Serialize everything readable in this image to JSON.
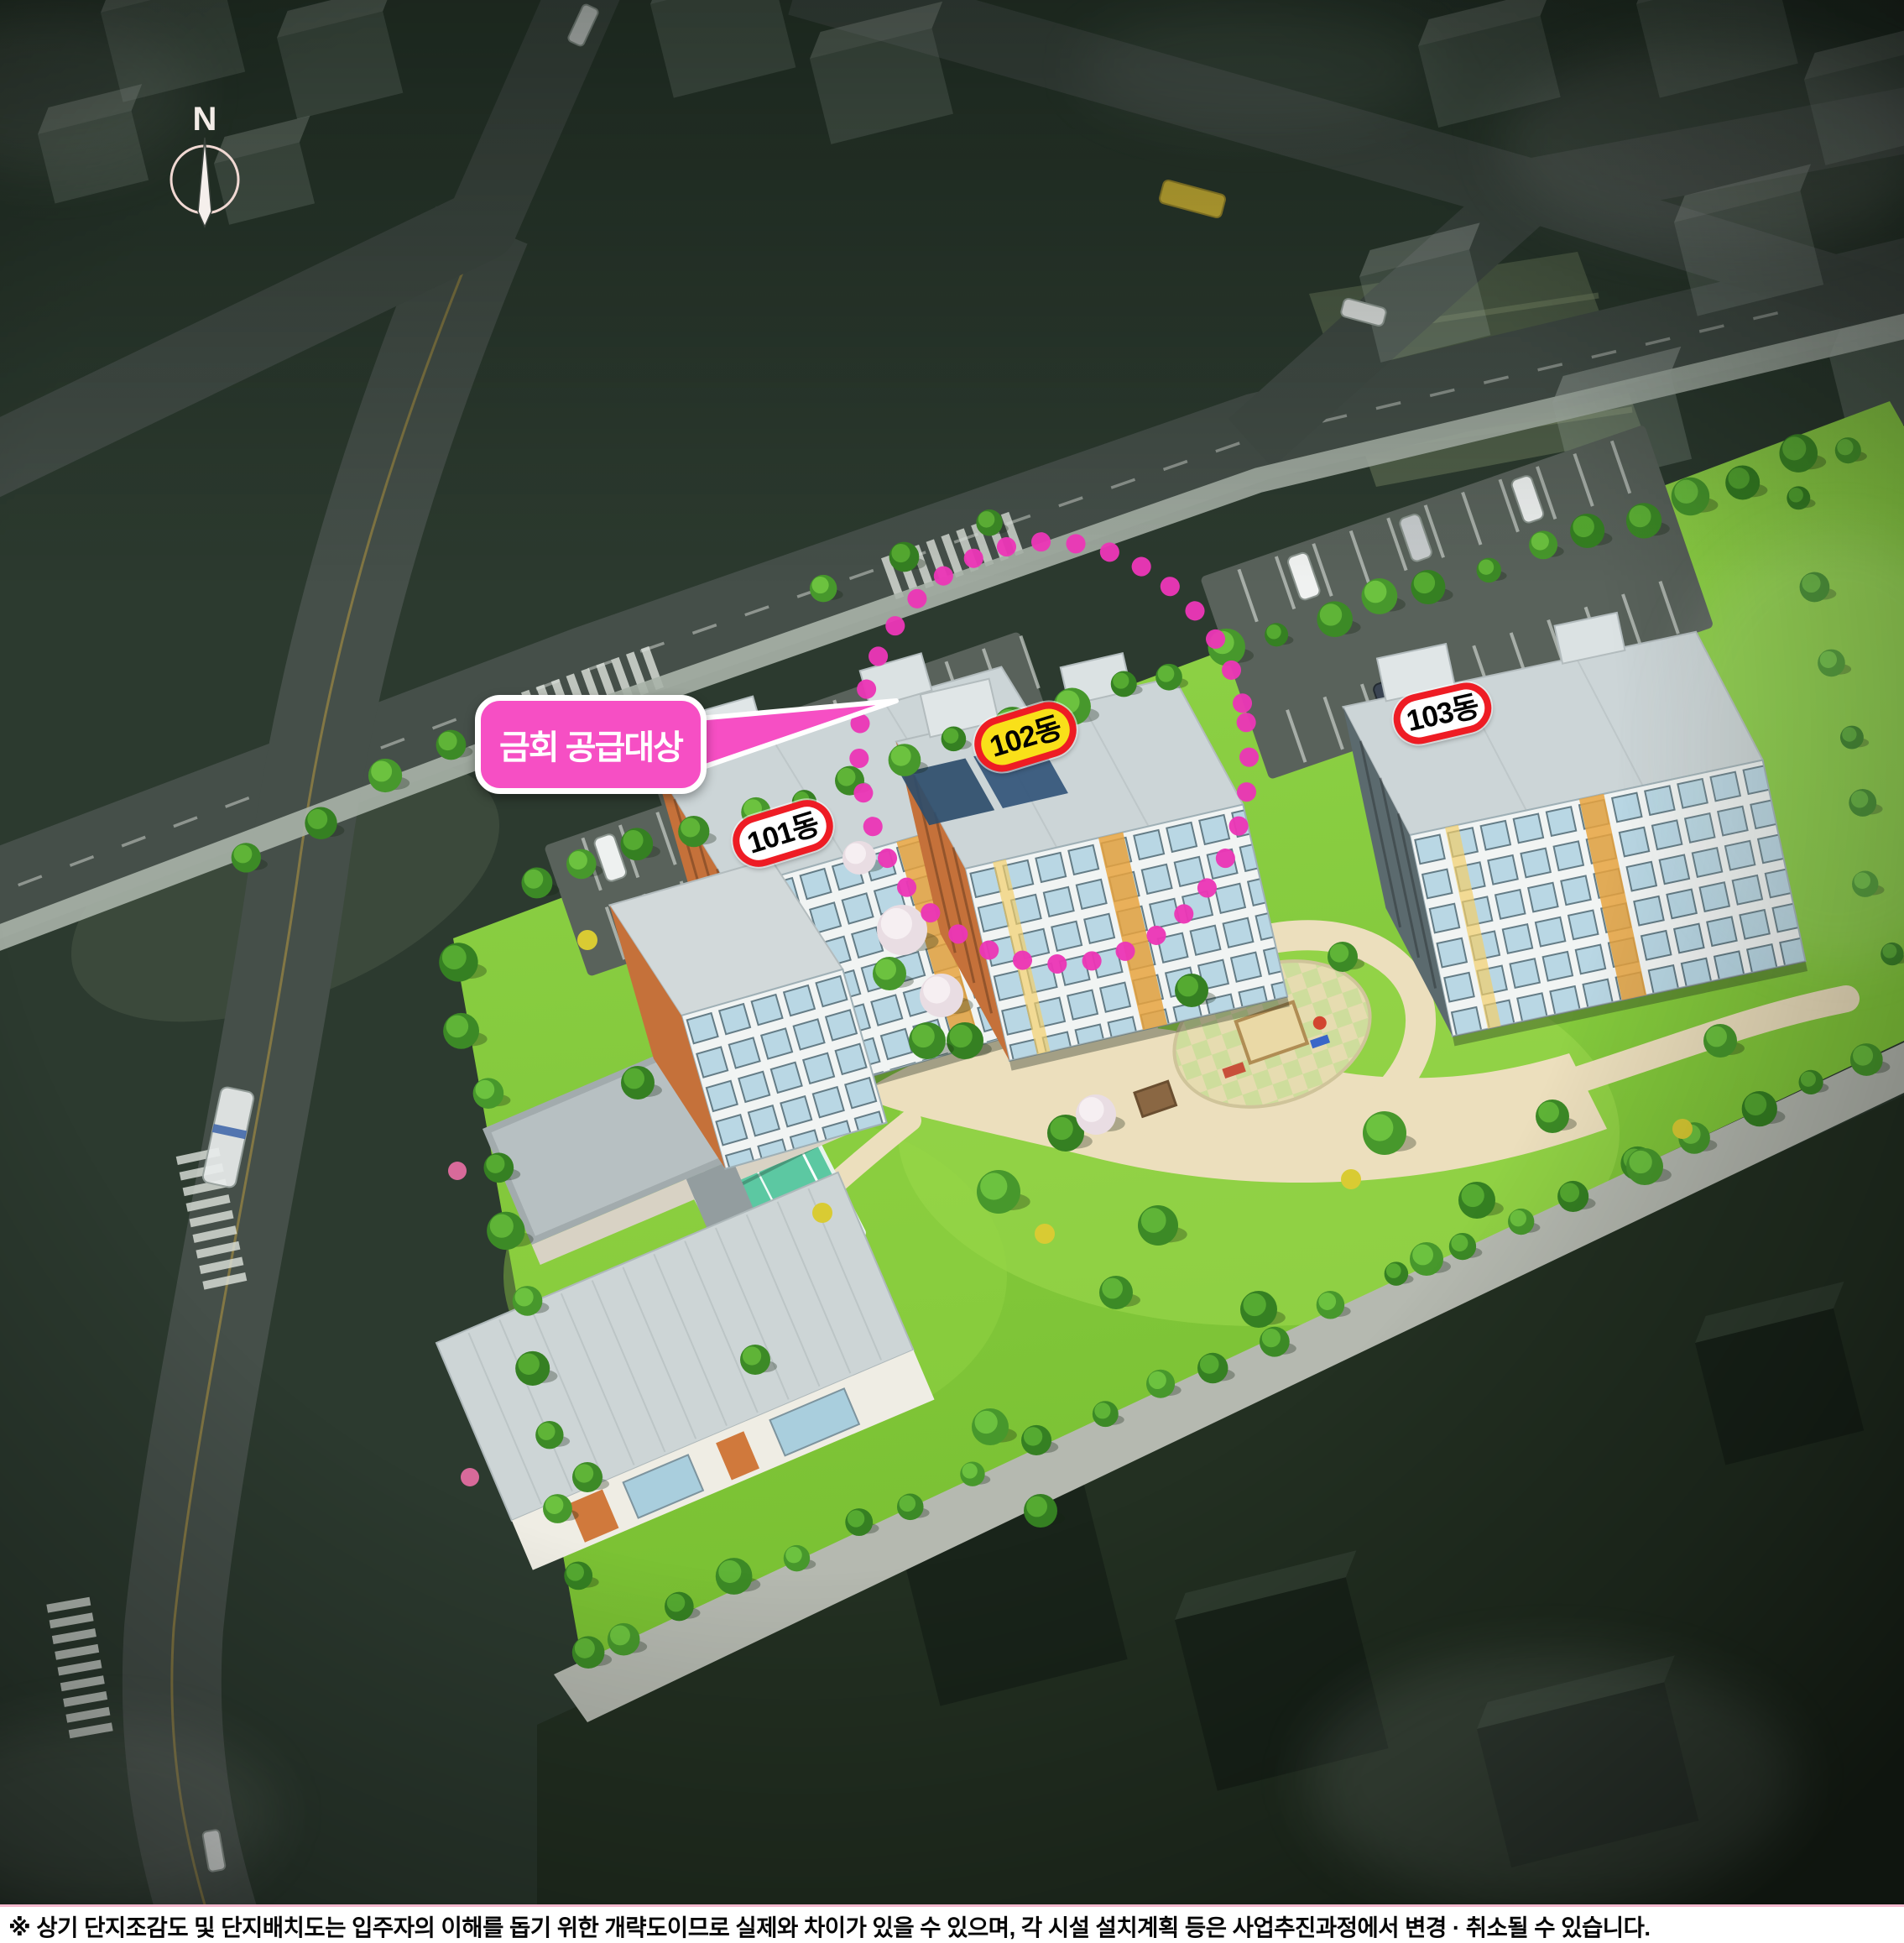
{
  "compass": {
    "label": "N"
  },
  "callout": {
    "label": "금회 공급대상",
    "fill": "#f64fc4",
    "border": "#ffffff",
    "points_to": "102동"
  },
  "buildings": [
    {
      "label": "101동",
      "badge_fill": "#ffffff",
      "badge_border": "#ee1c24",
      "highlighted": false
    },
    {
      "label": "102동",
      "badge_fill": "#f9e019",
      "badge_border": "#ee1c24",
      "highlighted": true
    },
    {
      "label": "103동",
      "badge_fill": "#ffffff",
      "badge_border": "#ee1c24",
      "highlighted": false
    }
  ],
  "highlight_circle": {
    "style": "dotted",
    "color": "#eb36b6",
    "encircles": "102동"
  },
  "site_features": {
    "amenities": [
      "tennis-court",
      "playground",
      "community-buildings",
      "parking-lots",
      "park"
    ],
    "grass_color": "#84ca3a",
    "path_color": "#ecdfbd",
    "court_color": "#5cc8a2"
  },
  "footer": {
    "disclaimer": "※ 상기 단지조감도 및 단지배치도는 입주자의 이해를 돕기 위한 개략도이므로 실제와 차이가 있을 수 있으며, 각 시설 설치계획 등은 사업추진과정에서 변경 · 취소될 수 있습니다."
  }
}
